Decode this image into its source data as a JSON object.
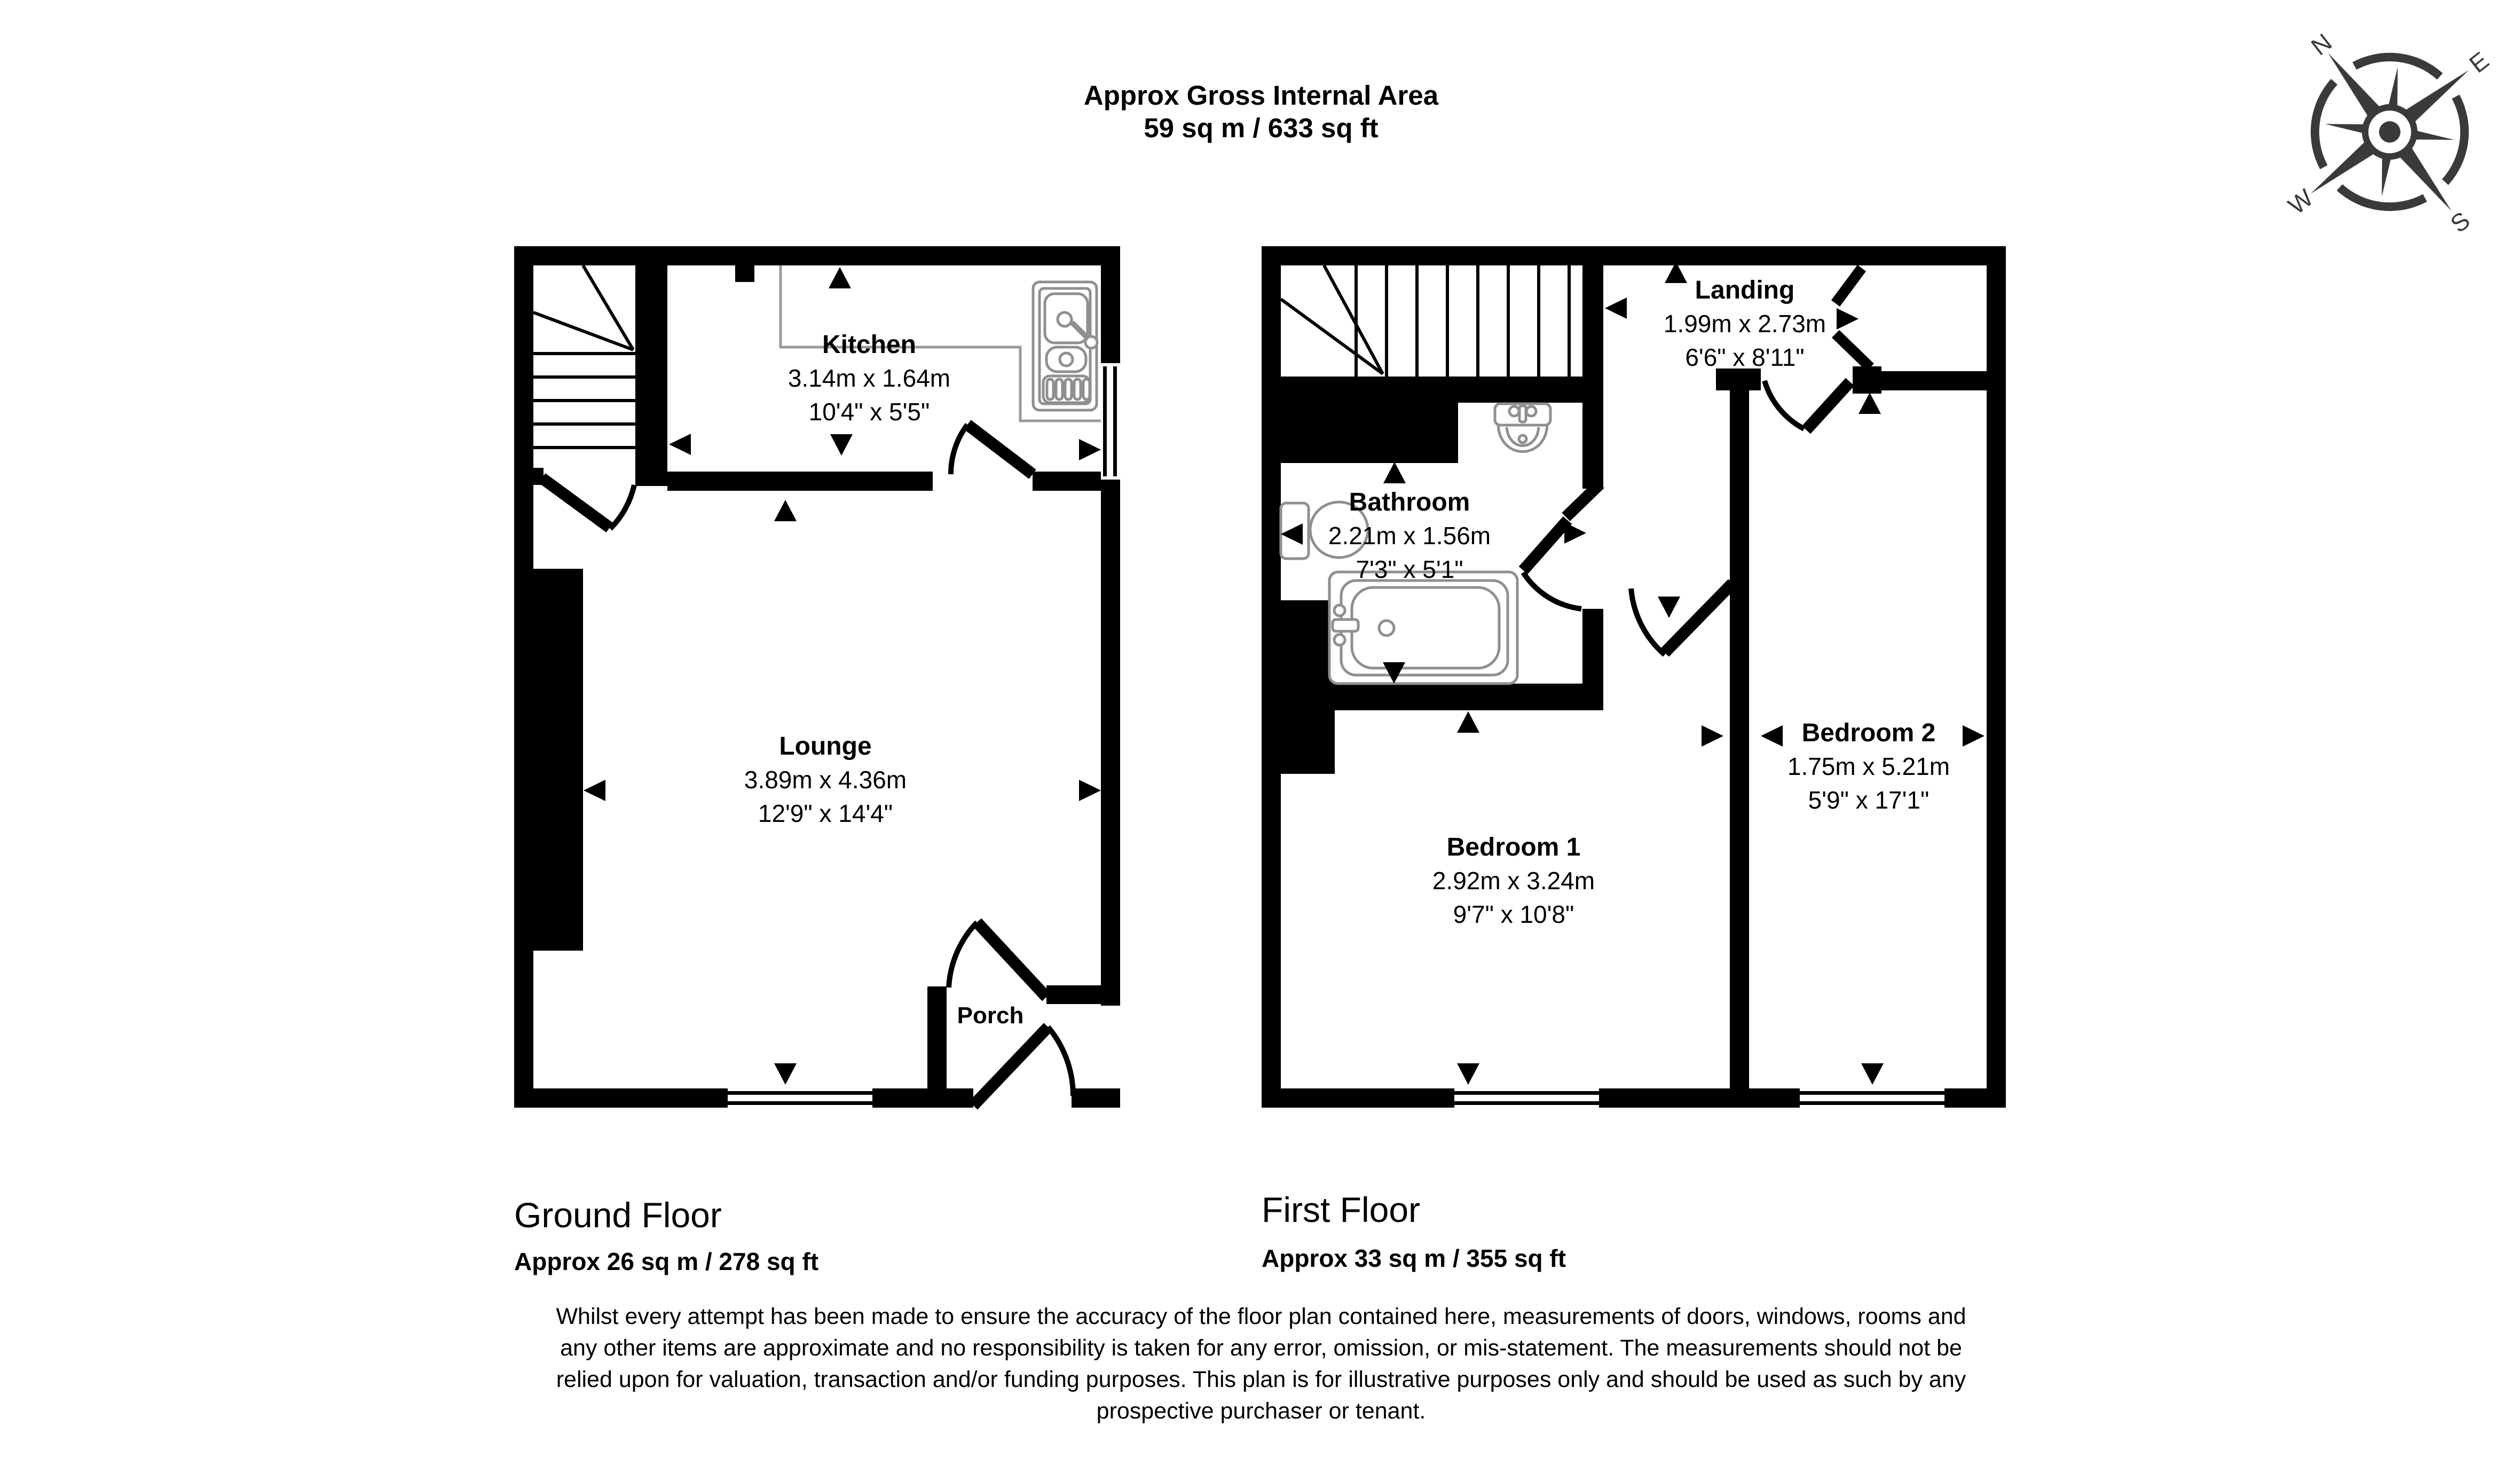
{
  "title": {
    "line1": "Approx Gross Internal Area",
    "line2": "59 sq m / 633 sq ft"
  },
  "compass": {
    "n": "N",
    "e": "E",
    "s": "S",
    "w": "W"
  },
  "ground_floor": {
    "name": "Ground Floor",
    "area": "Approx 26 sq m / 278 sq ft",
    "rooms": {
      "kitchen": {
        "name": "Kitchen",
        "metric": "3.14m x 1.64m",
        "imperial": "10'4\" x 5'5\""
      },
      "lounge": {
        "name": "Lounge",
        "metric": "3.89m x 4.36m",
        "imperial": "12'9\" x 14'4\""
      },
      "porch": {
        "name": "Porch"
      }
    }
  },
  "first_floor": {
    "name": "First Floor",
    "area": "Approx 33 sq m / 355 sq ft",
    "rooms": {
      "landing": {
        "name": "Landing",
        "metric": "1.99m x 2.73m",
        "imperial": "6'6\" x 8'11\""
      },
      "bathroom": {
        "name": "Bathroom",
        "metric": "2.21m x 1.56m",
        "imperial": "7'3\" x 5'1\""
      },
      "bedroom1": {
        "name": "Bedroom 1",
        "metric": "2.92m x 3.24m",
        "imperial": "9'7\" x 10'8\""
      },
      "bedroom2": {
        "name": "Bedroom 2",
        "metric": "1.75m x 5.21m",
        "imperial": "5'9\" x 17'1\""
      }
    }
  },
  "disclaimer": {
    "lines": [
      "Whilst every attempt has been made to ensure the accuracy of the floor plan contained here, measurements of doors, windows, rooms and",
      "any other items are approximate and no responsibility is taken for any error, omission, or mis-statement. The measurements should not be",
      "relied upon for valuation, transaction and/or funding purposes. This plan is for illustrative purposes only and should be used as such by any",
      "prospective purchaser or tenant."
    ]
  },
  "colors": {
    "wall": "#000000",
    "fixture": "#8f8f8f",
    "compass": "#3a3a3a"
  }
}
